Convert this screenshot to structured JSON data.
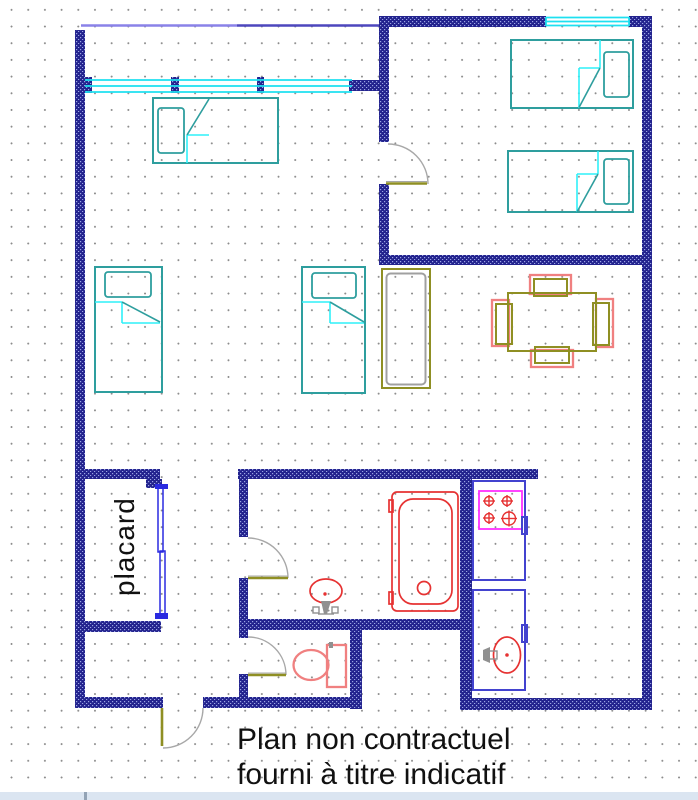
{
  "labels": {
    "closet": "placard",
    "disclaimer_line1": "Plan non contractuel",
    "disclaimer_line2": "fourni à titre indicatif"
  },
  "colors": {
    "wall": "#23238e",
    "wall_speckle": "#9aa5e4",
    "window": "#1ee0f0",
    "bed_frame": "#2e9e9e",
    "bed_sheet": "#2ff0f8",
    "furniture_olive": "#8f8f23",
    "red_fixture": "#e63232",
    "salmon_fixture": "#f08080",
    "stove_magenta": "#ff30ff",
    "kitchen_unit": "#4343cf",
    "closet_door": "#2a2ae0",
    "door_arc": "#a8a8a8",
    "door_leaf": "#8f8f23",
    "line_left": "#8a82e8",
    "line_right": "#4d47bd",
    "dot_grid": "#8c8c8c",
    "text": "#111111",
    "bottom_bar": "#dbe5f1",
    "bottom_bar_tick": "#93a3b5",
    "inner_gray": "#a0a0a0",
    "faucet_gray": "#909090"
  }
}
